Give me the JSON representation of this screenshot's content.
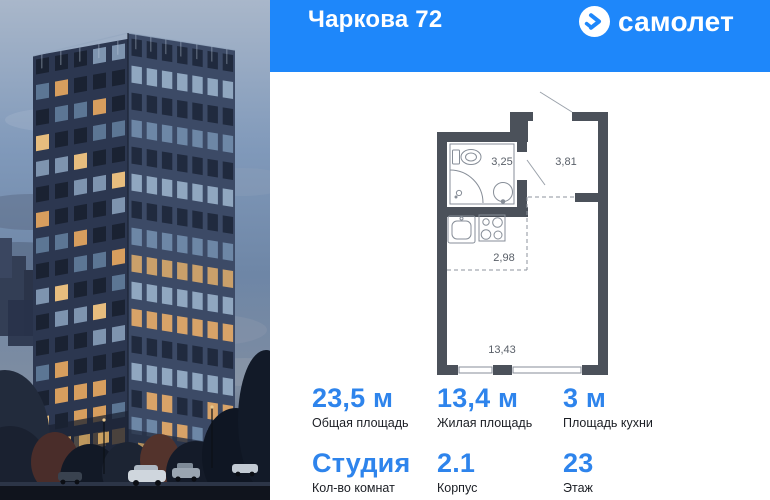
{
  "header": {
    "title": "Чаркова 72",
    "brand": "самолет"
  },
  "brand_colors": {
    "header_bg": "#1e87fa",
    "value_blue": "#2e84ec",
    "plan_wall": "#4b515a"
  },
  "floor_plan": {
    "bathroom_area": "3,25",
    "hallway_area": "3,81",
    "kitchen_area": "2,98",
    "living_area": "13,43"
  },
  "stats": {
    "row1": [
      {
        "value": "23,5 м",
        "label": "Общая площадь"
      },
      {
        "value": "13,4 м",
        "label": "Жилая площадь"
      },
      {
        "value": "3 м",
        "label": "Площадь кухни"
      }
    ],
    "row2": [
      {
        "value": "Студия",
        "label": "Кол-во комнат"
      },
      {
        "value": "2.1",
        "label": "Корпус"
      },
      {
        "value": "23",
        "label": "Этаж"
      }
    ]
  }
}
